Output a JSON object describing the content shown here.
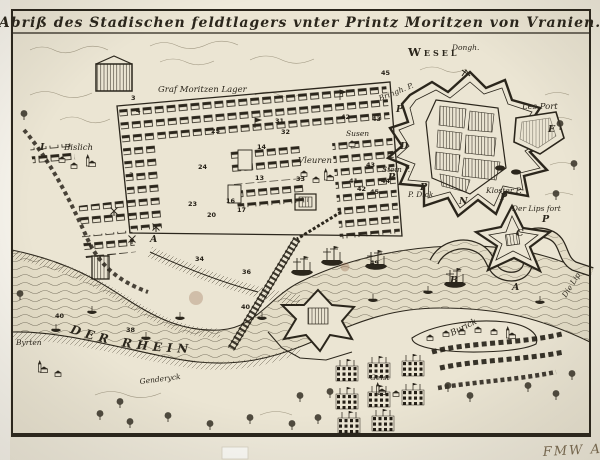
{
  "artwork": {
    "title": "Abriß des Stadischen feldtlagers vnter Printz Moritzen von Vranien.",
    "handwritten_mark": "FMW A"
  },
  "map": {
    "labels": {
      "wesel": "Wesel",
      "dongh": "Dongh.",
      "camp": "Graf Moritzen Lager",
      "rhine": "DER RHEIN",
      "les_port": "Les Port",
      "bringh": "Bringh. P.",
      "stein": "Stein P.",
      "dick": "P. Dick",
      "kloster": "Kloster P.",
      "der_lips_fort": "Der Lips fort",
      "die_lip": "Die Lip",
      "susen": "Susen",
      "vleuren": "Vleuren",
      "bislich": "Bislich",
      "byrten": "Byrten",
      "genderyck": "Genderyck",
      "burick": "Burick",
      "geist": "Geist"
    },
    "letters": {
      "a": "A",
      "b": "B",
      "c": "C",
      "d": "D",
      "e": "E",
      "i": "I",
      "n": "N",
      "p": "P"
    },
    "numbers": [
      "3",
      "4",
      "3",
      "25",
      "24",
      "23",
      "20",
      "17",
      "16",
      "13",
      "14",
      "31",
      "32",
      "33",
      "34",
      "36",
      "40",
      "38",
      "40",
      "41",
      "42",
      "43",
      "44",
      "45",
      "42",
      "43",
      "45",
      "49"
    ],
    "colors": {
      "paper": "#ece6d5",
      "ink": "#2b261c",
      "river_tone": "#e4ddc7",
      "stain": "#8b5a3c"
    }
  }
}
